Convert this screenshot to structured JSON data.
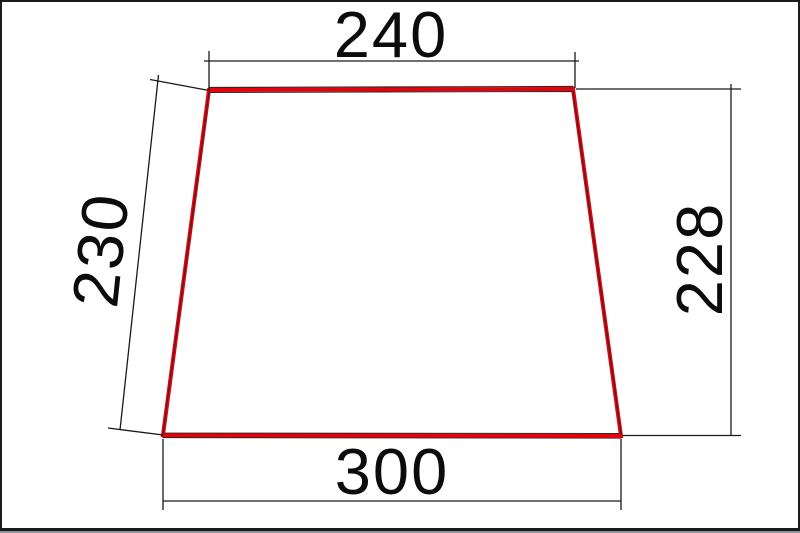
{
  "window": {
    "background": "#ffffff",
    "frame_color": "#1b1b1b",
    "bottom_strip_color": "#8d929a"
  },
  "drawing": {
    "type": "dimensioned-trapezoid",
    "outline_color": "#e8000a",
    "line_color": "#1a1a1a",
    "dimensions": {
      "top_width": "240",
      "left_side": "230",
      "right_side": "228",
      "bottom_width": "300"
    }
  }
}
